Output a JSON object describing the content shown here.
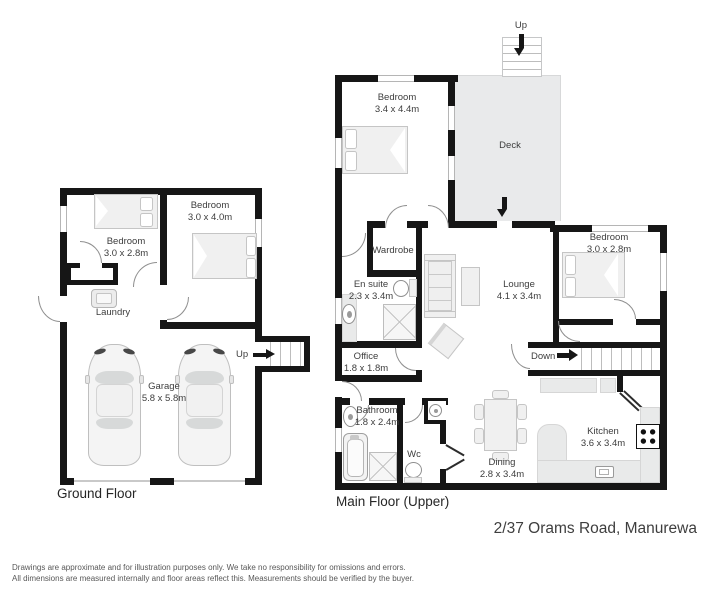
{
  "footer": {
    "address": "2/37 Orams Road, Manurewa",
    "disclaimer_line1": "Drawings are approximate and for illustration purposes only. We take no responsibility for omissions and errors.",
    "disclaimer_line2": "All dimensions are measured internally and floor areas reflect this. Measurements should be verified by the buyer."
  },
  "ground_floor": {
    "label": "Ground Floor",
    "stairs_up": "Up",
    "rooms": {
      "bedroom_left": {
        "name": "Bedroom",
        "dims": "3.0 x 2.8m"
      },
      "bedroom_right": {
        "name": "Bedroom",
        "dims": "3.0 x 4.0m"
      },
      "laundry": {
        "name": "Laundry"
      },
      "garage": {
        "name": "Garage",
        "dims": "5.8 x 5.8m"
      }
    }
  },
  "main_floor": {
    "label": "Main Floor (Upper)",
    "stairs_up": "Up",
    "stairs_down": "Down",
    "rooms": {
      "bedroom_master": {
        "name": "Bedroom",
        "dims": "3.4 x 4.4m"
      },
      "deck": {
        "name": "Deck"
      },
      "bedroom_right": {
        "name": "Bedroom",
        "dims": "3.0 x 2.8m"
      },
      "wardrobe": {
        "name": "Wardrobe"
      },
      "ensuite": {
        "name": "En suite",
        "dims": "2.3 x 3.4m"
      },
      "lounge": {
        "name": "Lounge",
        "dims": "4.1 x 3.4m"
      },
      "office": {
        "name": "Office",
        "dims": "1.8 x 1.8m"
      },
      "bathroom": {
        "name": "Bathroom",
        "dims": "1.8 x 2.4m"
      },
      "wc": {
        "name": "Wc"
      },
      "dining": {
        "name": "Dining",
        "dims": "2.8 x 3.4m"
      },
      "kitchen": {
        "name": "Kitchen",
        "dims": "3.6 x 3.4m"
      }
    }
  },
  "icons": {
    "bed-icon": "css-shape",
    "car-icon": "css-shape",
    "sofa-icon": "css-shape",
    "toilet-icon": "css-shape",
    "bathtub-icon": "css-shape",
    "shower-icon": "css-shape",
    "sink-icon": "css-shape",
    "stove-icon": "css-shape",
    "dining-table-icon": "css-shape",
    "washer-icon": "css-shape",
    "stairs-icon": "css-shape",
    "arrow-icon": "css-shape",
    "door-arc-icon": "css-shape"
  },
  "colors": {
    "wall": "#161616",
    "deck": "#e9eaeb",
    "counter": "#e9eaea",
    "furniture": "#f0f0f0",
    "text": "#3d3d3d",
    "background": "#ffffff"
  }
}
